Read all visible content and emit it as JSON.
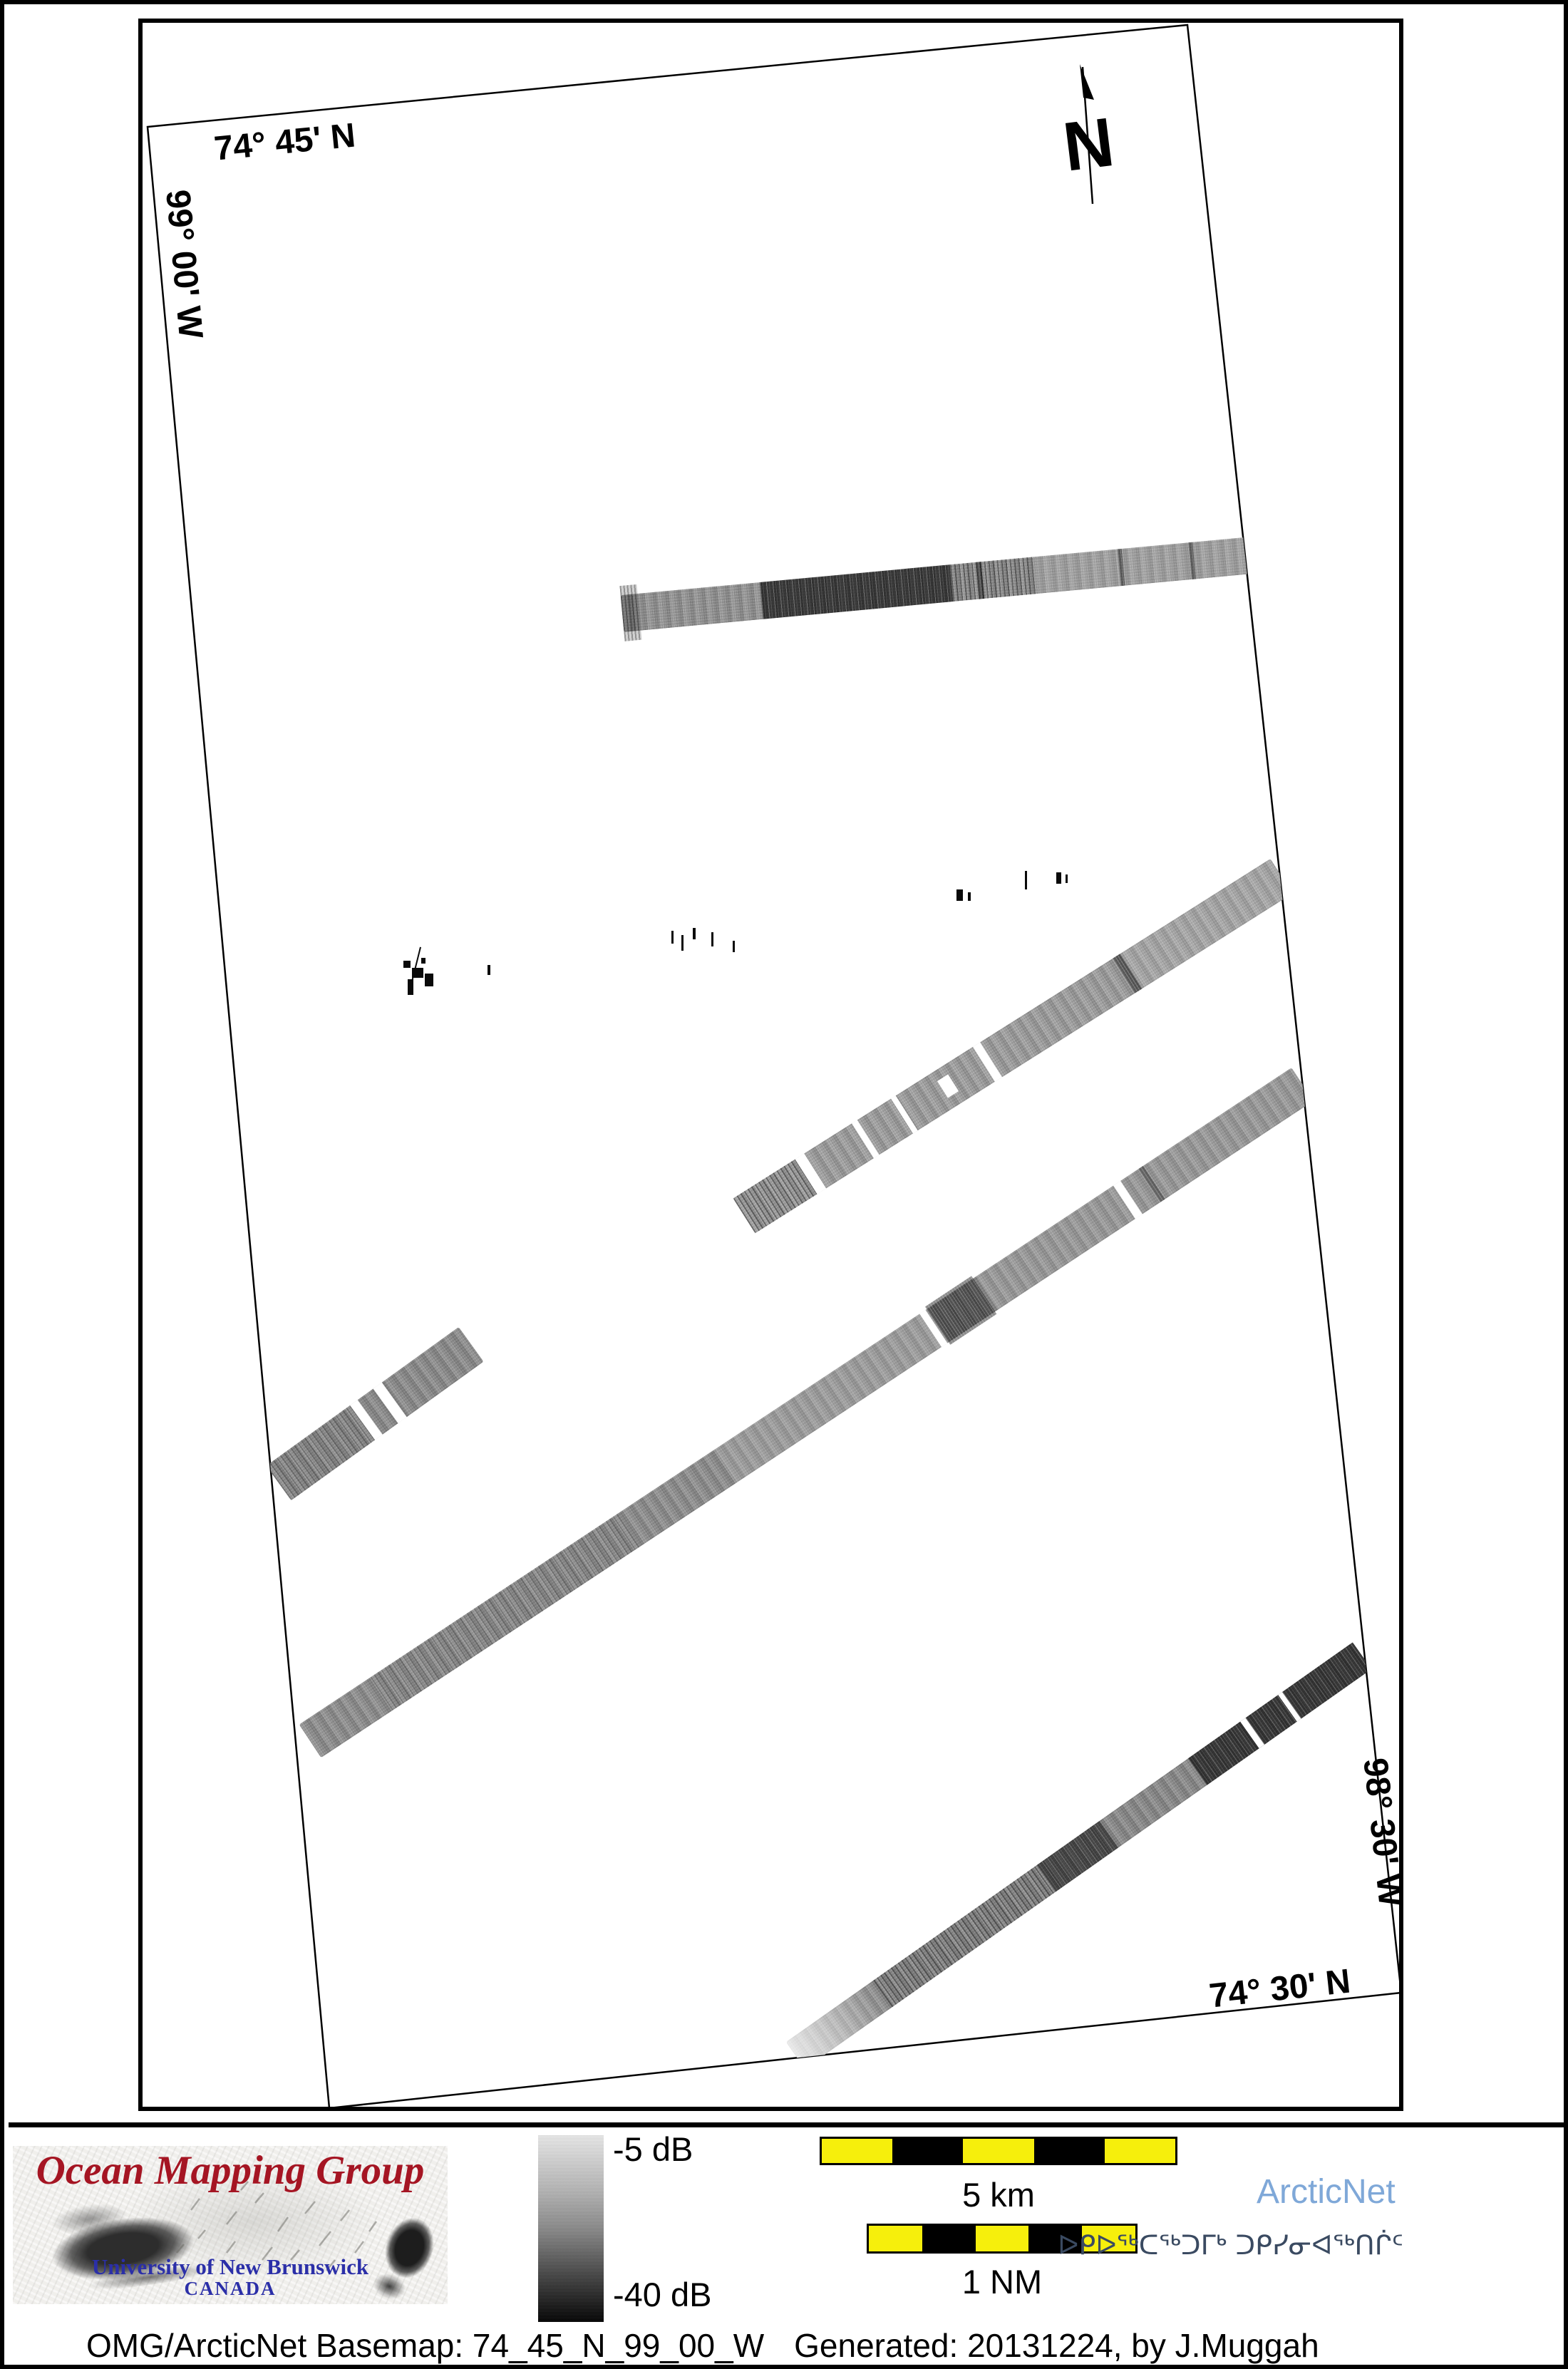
{
  "map": {
    "grid_labels": {
      "lat_top": "74° 45' N",
      "lon_left": "99° 00' W",
      "lon_right": "98° 30' W",
      "lat_bottom": "74° 30' N"
    },
    "north_arrow_label": "N",
    "swaths": [
      "top-survey-line",
      "middle-survey-line",
      "long-diagonal-survey-line",
      "bottom-right-survey-line",
      "left-survey-segment",
      "scattered-sonar-targets"
    ]
  },
  "legend": {
    "max_label": "-5 dB",
    "min_label": "-40 dB"
  },
  "scalebars": {
    "km_label": "5 km",
    "nm_label": "1 NM"
  },
  "branding": {
    "omg_title": "Ocean Mapping Group",
    "omg_university": "University of New Brunswick",
    "omg_country": "CANADA",
    "arcticnet": "ArcticNet",
    "arcticnet_inuktitut": "ᐅᑭᐅᖅᑕᖅᑐᒥᒃ ᑐᑭᓯᓂᐊᖅᑎᒌᑦ"
  },
  "caption": {
    "basemap": "OMG/ArcticNet Basemap: 74_45_N_99_00_W",
    "generated": "Generated: 20131224, by J.Muggah"
  },
  "colors": {
    "omg_red": "#a51523",
    "unb_blue": "#2b2fa8",
    "arcticnet_blue": "#7fa8d8",
    "inuktitut_blue": "#3a4a61",
    "scalebar_yellow": "#f6ef0c"
  }
}
